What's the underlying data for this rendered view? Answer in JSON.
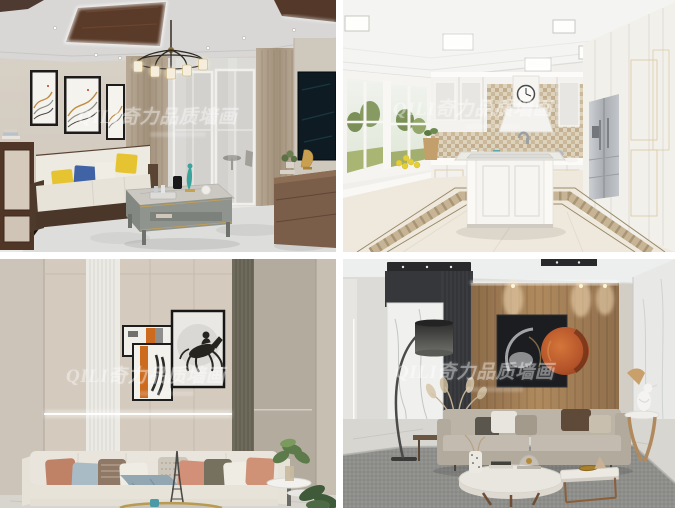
{
  "page": {
    "width_px": 675,
    "height_px": 508,
    "background": "#ffffff",
    "layout": "2x2 interior-design photo grid with white gutters"
  },
  "watermark": {
    "text": "QILI奇力品质墙画",
    "color": "#ffffff",
    "opacity": 0.38,
    "style": "bold italic serif, semi-transparent, centered on each photo"
  },
  "photos": [
    {
      "position": "top-left",
      "subject": "new-chinese-living-room",
      "watermark": "QILI奇力品质墙画"
    },
    {
      "position": "top-right",
      "subject": "white-european-kitchen",
      "watermark": "QILI奇力品质墙画"
    },
    {
      "position": "bottom-left",
      "subject": "horse-art-living-room",
      "watermark": "QILI奇力品质墙画"
    },
    {
      "position": "bottom-right",
      "subject": "wood-slat-wall-living-room",
      "watermark": "QILI奇力品质墙画"
    }
  ],
  "palette": {
    "wall_beige": "#d5cec4",
    "coffer_wood": "#5a3a28",
    "curtain_tan": "#b6a794",
    "cushion_yellow": "#e6c431",
    "cushion_blue": "#3f63a5",
    "art_orange": "#cc6a1e",
    "copper_disc": "#b5542a",
    "olive_panel": "#6e6b5d",
    "stainless_steel": "#b7bbbf",
    "kitchen_white": "#f3f1ed",
    "rug_gray": "#8e8e8b"
  }
}
